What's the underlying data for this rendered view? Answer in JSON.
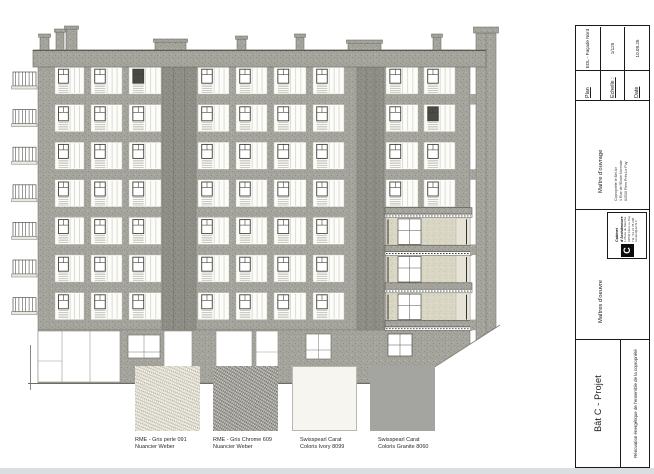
{
  "sheet": {
    "drawing_title": "EDL - Façade Nord"
  },
  "materials": {
    "items": [
      {
        "line1": "RME - Gris perle 091",
        "line2": "Nuancier Weber"
      },
      {
        "line1": "RME - Gris Chrome 609",
        "line2": "Nuancier Weber"
      },
      {
        "line1": "Swisspearl Carat",
        "line2": "Coloris Ivory 8099"
      },
      {
        "line1": "Swisspearl Carat",
        "line2": "Coloris Granite 8060"
      }
    ]
  },
  "title_block": {
    "project": {
      "name": "Bât C - Projet",
      "description": "Rénovation énergétique de l'ensemble de la copropriété"
    },
    "maitre_oeuvre": {
      "label": "Maîtres d'oeuvre",
      "firm": "Cabinet d'Architecture",
      "logo": "C",
      "details": [
        "1 Place du Marché",
        "62530 Flers Le Puy",
        "Tél : 03 21 78 208",
        "contact@archi.fr"
      ]
    },
    "maitre_ouvrage": {
      "label": "Maître d'ouvrage",
      "details": [
        "Copropriété le Bel Air",
        "1 Rue de l'École Normale",
        "62530 Flers Près Le Puy"
      ]
    },
    "plan": {
      "label": "Plan",
      "value": "EDL - Façade Nord"
    },
    "echelle": {
      "label": "Echelle :",
      "value": "1/125"
    },
    "date": {
      "label": "Date",
      "value": "10.08.25"
    }
  },
  "colors": {
    "facade_gray": "#a5a59d",
    "dark_strip": "#8f8f88",
    "beige_infill": "#d9d6c4",
    "line": "#1a1a1a"
  }
}
